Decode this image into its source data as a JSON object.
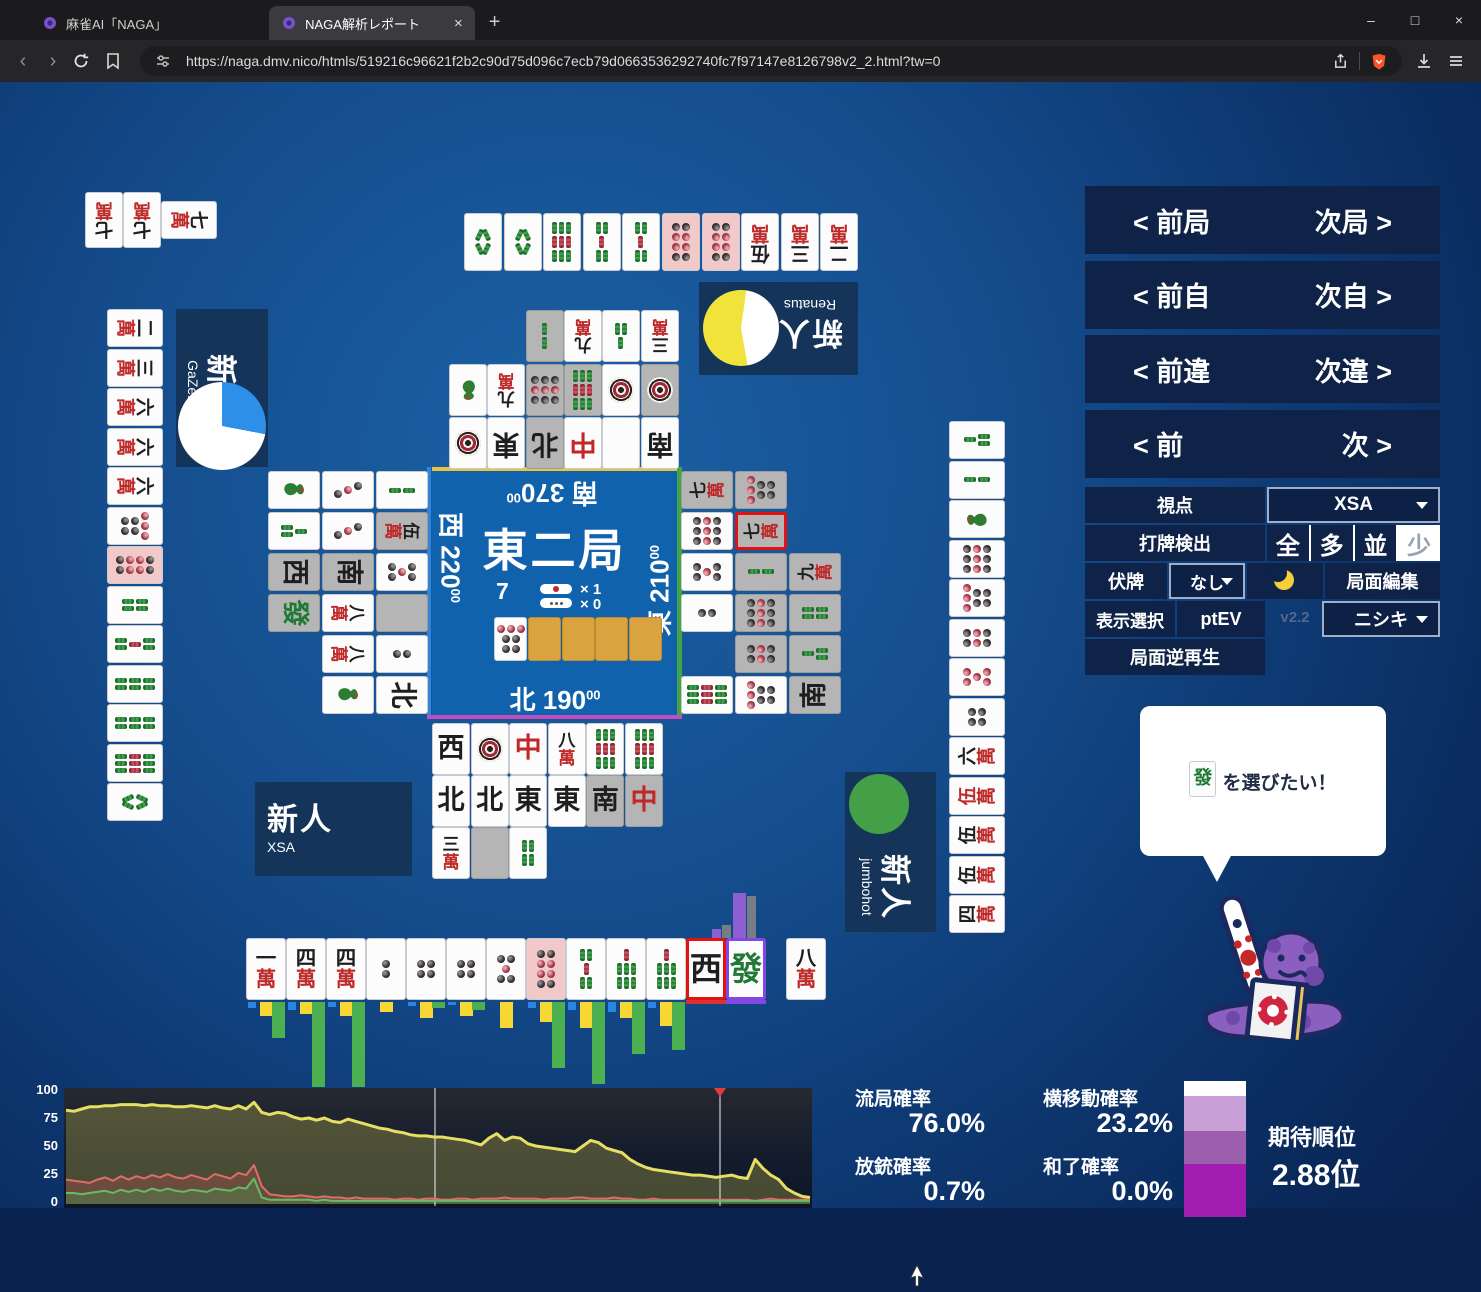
{
  "browser": {
    "tab1": "麻雀AI「NAGA」",
    "tab2": "NAGA解析レポート",
    "close_tab": "×",
    "new_tab": "+",
    "url": "https://naga.dmv.nico/htmls/519216c96621f2b2c90d75d096c7ecb79d0663536292740fc7f97147e8126798v2_2.html?tw=0",
    "window": {
      "min": "–",
      "max": "□",
      "close": "×"
    }
  },
  "nav": {
    "rows": [
      {
        "left": "< 前局",
        "right": "次局 >"
      },
      {
        "left": "< 前自",
        "right": "次自 >"
      },
      {
        "left": "< 前違",
        "right": "次違 >"
      },
      {
        "left": "< 前",
        "right": "次 >"
      }
    ]
  },
  "controls": {
    "viewpoint_label": "視点",
    "viewpoint_value": "XSA",
    "dahai_label": "打牌検出",
    "dahai_options": [
      "全",
      "多",
      "並",
      "少"
    ],
    "dahai_selected": "少",
    "fusehai_label": "伏牌",
    "fusehai_value": "なし",
    "kyokumen_edit": "局面編集",
    "display_label": "表示選択",
    "display_value": "ptEV",
    "version": "v2.2",
    "model_value": "ニシキ",
    "reverse_play": "局面逆再生"
  },
  "board": {
    "round": "東二局",
    "wall_count": "7",
    "riichi_sticks": "× 1",
    "honba_sticks": "× 0",
    "seats": {
      "top": {
        "wind": "南",
        "score": "370",
        "score_small": "00"
      },
      "left": {
        "wind": "西",
        "score": "220",
        "score_small": "00"
      },
      "right": {
        "wind": "東",
        "score": "210",
        "score_small": "00"
      },
      "bottom": {
        "wind": "北",
        "score": "190",
        "score_small": "00"
      }
    },
    "dora_indicator": "7p",
    "hidden_indicator_count": 4
  },
  "players": {
    "left": {
      "rank": "新人",
      "name": "GaZeLle",
      "pie": {
        "from": 0,
        "segments": [
          [
            "#2e8fe8",
            28
          ],
          [
            "#ffffff",
            72
          ]
        ]
      }
    },
    "top": {
      "rank": "新人",
      "name": "Renatus",
      "pie": {
        "from": 170,
        "segments": [
          [
            "#f2e23c",
            55
          ],
          [
            "#ffffff",
            45
          ]
        ]
      }
    },
    "right": {
      "rank": "新人",
      "name": "jumbohot",
      "pie": {
        "from": 0,
        "segments": [
          [
            "#43a047",
            100
          ]
        ]
      }
    },
    "bottom": {
      "rank": "新人",
      "name": "XSA"
    }
  },
  "hands": {
    "top_meld": {
      "tiles": [
        "7m",
        "7m"
      ],
      "rotated_tile": "7m"
    },
    "top": [
      "8s",
      "8s",
      "9s",
      "5s",
      "5s",
      "8p|k",
      "8p|k",
      "5m",
      "3m",
      "2m"
    ],
    "left": [
      "2m",
      "3m",
      "6m",
      "6m",
      "6m",
      "7p",
      "8p|k",
      "4s",
      "5s",
      "6s",
      "6s",
      "9s",
      "8s"
    ],
    "right": [
      "3s",
      "2s",
      "1s",
      "9p",
      "7p",
      "6p",
      "0p",
      "4p",
      "6m",
      "0m",
      "5m",
      "5m",
      "4m"
    ],
    "bottom": [
      "1m",
      "4m",
      "4m",
      "2p",
      "4p",
      "4p",
      "5p",
      "8p|k",
      "5s",
      "7s",
      "7s",
      "W|rf",
      "P|pf"
    ],
    "bottom_draw": "8m"
  },
  "ponds": {
    "top": [
      [
        null,
        null,
        "2s|g",
        "9m",
        "3s",
        "3m"
      ],
      [
        "1s",
        "9m",
        "9p|g",
        "9s|g",
        "1p",
        "1p|g"
      ],
      [
        "1p",
        "E",
        "N|g",
        "C",
        "Hk",
        "S"
      ]
    ],
    "left": [
      [
        "1s",
        "3p",
        "2s"
      ],
      [
        "3s",
        "3p",
        "5m|g"
      ],
      [
        "W|g",
        "S|g",
        "5p"
      ],
      [
        "P|g",
        "8m",
        "Hk|g"
      ],
      [
        null,
        "8m",
        "2p"
      ],
      [
        null,
        "1s",
        "N"
      ]
    ],
    "right": [
      [
        "7m|g",
        "7p|g",
        null
      ],
      [
        "9p",
        "7m|g|rf",
        null
      ],
      [
        "5p",
        "2s|g",
        "9m|g"
      ],
      [
        "2p",
        "9p|g",
        "4s|g"
      ],
      [
        null,
        "6p|g",
        "3s|g"
      ],
      [
        "9s",
        "7p",
        "S|g"
      ]
    ],
    "bottom": [
      [
        "W",
        "1p",
        "C",
        "8m",
        "9s",
        "9s"
      ],
      [
        "N",
        "N",
        "E",
        "E",
        "S|g",
        "C|g"
      ],
      [
        "3m",
        "Hk|g",
        "4s"
      ]
    ]
  },
  "analysis": {
    "bar_colors": [
      "#2b86e3",
      "#f7d733",
      "#4caf50"
    ],
    "below_bars": [
      [
        6,
        14,
        36
      ],
      [
        8,
        12,
        85
      ],
      [
        5,
        14,
        85
      ],
      [
        0,
        10,
        0
      ],
      [
        4,
        16,
        6
      ],
      [
        3,
        14,
        8
      ],
      [
        0,
        26,
        0
      ],
      [
        6,
        20,
        66
      ],
      [
        8,
        26,
        82
      ],
      [
        10,
        16,
        52
      ],
      [
        6,
        24,
        48
      ],
      [
        0,
        0,
        0
      ],
      [
        0,
        0,
        0
      ]
    ],
    "above_bars": [
      {
        "x": 712,
        "w": 9,
        "h": 9,
        "color": "#8d5fd3"
      },
      {
        "x": 722,
        "w": 9,
        "h": 13,
        "color": "#787c84"
      },
      {
        "x": 733,
        "w": 13,
        "h": 45,
        "color": "#8d5fd3"
      },
      {
        "x": 747,
        "w": 9,
        "h": 42,
        "color": "#787c84"
      }
    ],
    "underlines": [
      {
        "x": 686,
        "w": 40,
        "color": "#e03131"
      },
      {
        "x": 726,
        "w": 40,
        "color": "#8347e6"
      }
    ]
  },
  "bubble": {
    "tile": "P",
    "text": "を選びたい！"
  },
  "stats": {
    "ryuukyoku_label": "流局確率",
    "ryuukyoku": "76.0%",
    "yokoidou_label": "横移動確率",
    "yokoidou": "23.2%",
    "houjuu_label": "放銃確率",
    "houjuu": "0.7%",
    "houra_label": "和了確率",
    "houra": "0.0%",
    "rank_label": "期待順位",
    "rank_value": "2.88位",
    "rank_bar": [
      [
        "#ffffff",
        11
      ],
      [
        "#c9a0d8",
        26
      ],
      [
        "#9c5fae",
        24
      ],
      [
        "#a21caf",
        39
      ]
    ]
  },
  "chart_data": {
    "type": "area-line",
    "title": "",
    "xlabel": "turn",
    "ylabel": "probability (%)",
    "y_ticks": [
      100,
      75,
      50,
      25,
      0
    ],
    "y_range": [
      0,
      100
    ],
    "grid": "vertical-markers-only",
    "gridlines_x_frac": [
      0.496,
      0.879
    ],
    "marker_x_frac": 0.879,
    "marker_color": "#e23b3b",
    "series": [
      {
        "name": "yellow",
        "color": "#e6df63",
        "values": [
          82,
          81,
          83,
          85,
          85,
          86,
          86,
          87,
          87,
          87,
          86,
          87,
          86,
          86,
          85,
          85,
          86,
          85,
          84,
          86,
          84,
          83,
          86,
          83,
          89,
          80,
          78,
          80,
          79,
          76,
          74,
          75,
          73,
          75,
          72,
          71,
          74,
          72,
          70,
          68,
          66,
          65,
          63,
          62,
          60,
          59,
          59,
          58,
          58,
          57,
          56,
          55,
          53,
          51,
          57,
          61,
          55,
          58,
          57,
          52,
          50,
          49,
          48,
          47,
          46,
          45,
          50,
          55,
          53,
          48,
          46,
          44,
          38,
          34,
          31,
          29,
          28,
          27,
          26,
          25,
          24,
          24,
          23,
          22,
          23,
          24,
          22,
          21,
          38,
          30,
          24,
          20,
          12,
          8,
          5,
          4
        ]
      },
      {
        "name": "red",
        "color": "#e06c6c",
        "values": [
          20,
          19,
          18,
          17,
          20,
          22,
          19,
          23,
          20,
          23,
          21,
          24,
          22,
          25,
          22,
          21,
          24,
          22,
          20,
          25,
          23,
          21,
          26,
          24,
          33,
          14,
          7,
          6,
          5,
          5,
          6,
          5,
          4,
          5,
          4,
          4,
          3,
          4,
          3,
          3,
          3,
          3,
          2,
          3,
          3,
          2,
          3,
          3,
          2,
          2,
          3,
          3,
          2,
          3,
          3,
          3,
          4,
          3,
          3,
          3,
          3,
          2,
          3,
          3,
          3,
          4,
          4,
          3,
          3,
          3,
          4,
          3,
          3,
          2,
          2,
          3,
          2,
          2,
          2,
          2,
          2,
          2,
          2,
          2,
          2,
          2,
          2,
          2,
          1,
          2,
          3,
          2,
          2,
          2,
          2,
          2
        ]
      },
      {
        "name": "green",
        "color": "#63bd68",
        "values": [
          8,
          8,
          7,
          8,
          9,
          10,
          8,
          11,
          9,
          11,
          9,
          12,
          10,
          12,
          10,
          9,
          11,
          10,
          9,
          12,
          11,
          10,
          13,
          12,
          21,
          4,
          2,
          2,
          2,
          2,
          2,
          2,
          1,
          2,
          1,
          1,
          1,
          1,
          1,
          1,
          1,
          1,
          1,
          1,
          1,
          1,
          1,
          1,
          1,
          1,
          1,
          1,
          1,
          1,
          1,
          1,
          1,
          1,
          1,
          1,
          1,
          1,
          1,
          1,
          1,
          1,
          1,
          1,
          1,
          1,
          1,
          1,
          1,
          1,
          1,
          1,
          1,
          1,
          1,
          1,
          1,
          1,
          1,
          1,
          1,
          1,
          1,
          1,
          1,
          1,
          1,
          1,
          1,
          1,
          1,
          1
        ]
      }
    ]
  }
}
